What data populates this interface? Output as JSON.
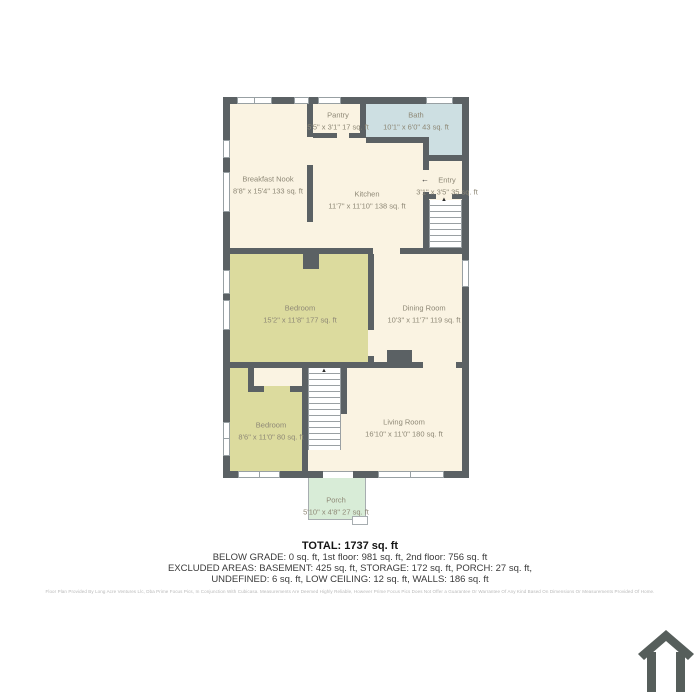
{
  "plan": {
    "rooms": [
      {
        "name": "Pantry",
        "dims": "5'5\" x 3'1\" 17 sq. ft"
      },
      {
        "name": "Bath",
        "dims": "10'1\" x 6'0\" 43 sq. ft"
      },
      {
        "name": "Breakfast Nook",
        "dims": "8'8\" x 15'4\" 133 sq. ft"
      },
      {
        "name": "Kitchen",
        "dims": "11'7\" x 11'10\" 138 sq. ft"
      },
      {
        "name": "Entry",
        "dims": "3'1\" x 3'5\" 35 sq. ft"
      },
      {
        "name": "Bedroom",
        "dims": "15'2\" x 11'8\" 177 sq. ft"
      },
      {
        "name": "Dining Room",
        "dims": "10'3\" x 11'7\" 119 sq. ft"
      },
      {
        "name": "Bedroom",
        "dims": "8'6\" x 11'0\" 80 sq. ft"
      },
      {
        "name": "Living Room",
        "dims": "16'10\" x 11'0\" 180 sq. ft"
      },
      {
        "name": "Porch",
        "dims": "5'10\" x 4'8\" 27 sq. ft"
      }
    ],
    "colors": {
      "wall": "#5b6164",
      "floor": "#faf3e2",
      "bedroom_fill": "#dcdb9e",
      "bath_fill": "#cddfe2",
      "porch_fill": "#d8ecd7",
      "label_text": "#8e8876"
    },
    "stair_arrow": "▲",
    "entry_arrow": "←"
  },
  "summary": {
    "total": "TOTAL: 1737 sq. ft",
    "line1": "BELOW GRADE: 0 sq. ft, 1st floor: 981 sq. ft, 2nd floor: 756 sq. ft",
    "line2": "EXCLUDED AREAS: BASEMENT: 425 sq. ft, STORAGE: 172 sq. ft, PORCH: 27 sq. ft,",
    "line3": "UNDEFINED: 6 sq. ft, LOW CEILING: 12 sq. ft, WALLS: 186 sq. ft",
    "disclaimer": "Floor Plan Provided By Long Acre Ventures Llc, Dba Prime Focus Pics, In Conjunction With Cubicasa. Measurements Are Deemed Highly Reliable, However Prime Focus Pics Does Not Offer a Guarantee Or Warrantee Of Any Kind Based On Dimensions Or Measurements Provided Of Home."
  }
}
